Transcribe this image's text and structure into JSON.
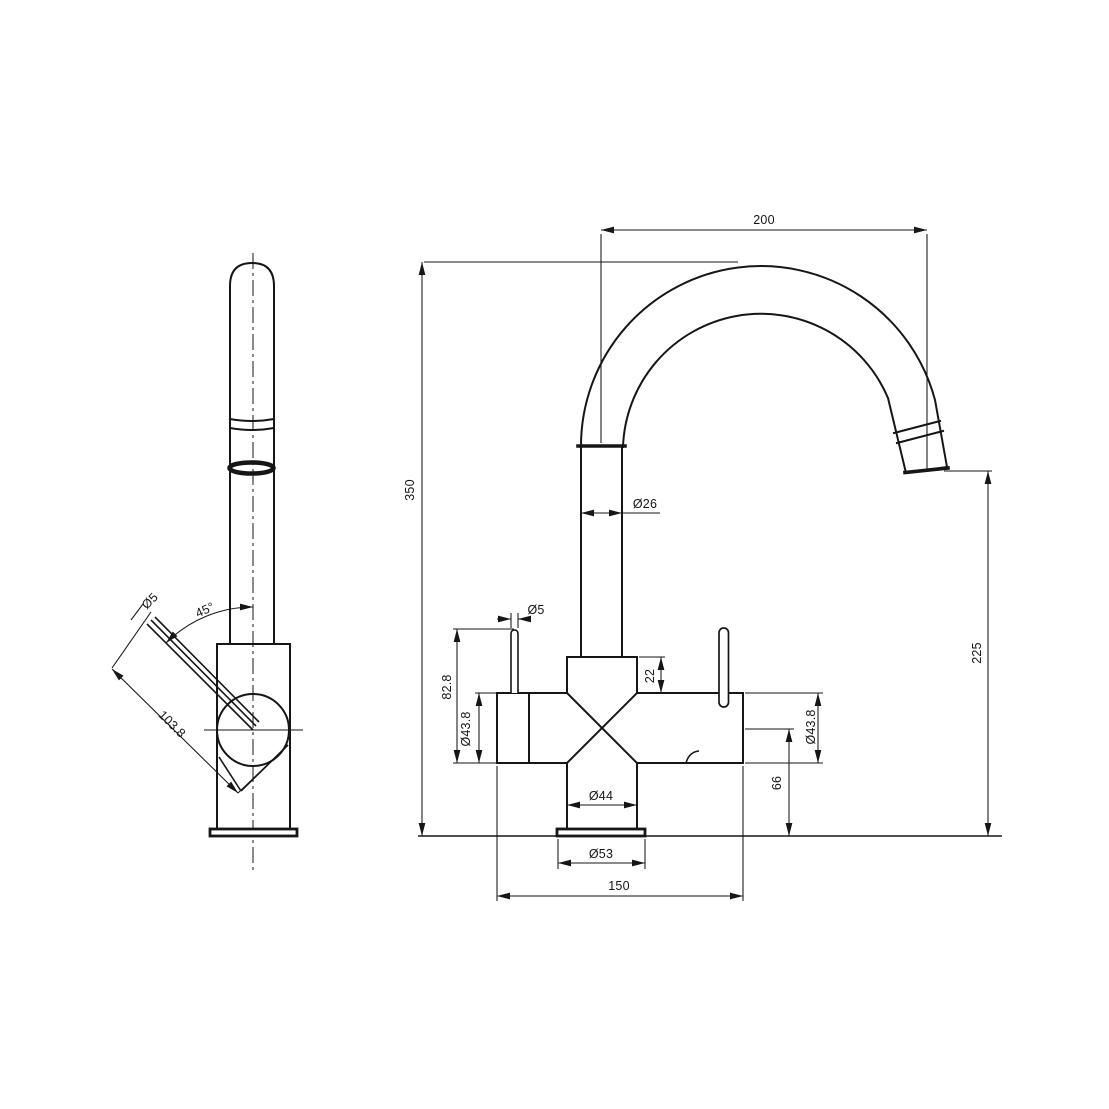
{
  "colors": {
    "background": "#ffffff",
    "line": "#161616"
  },
  "labels": {
    "reach": "200",
    "overall_height": "350",
    "spout_diameter": "Ø26",
    "pin_diameter_front": "Ø5",
    "handle_height": "82.8",
    "handle_diameter_left": "Ø43.8",
    "top_section_height": "22",
    "neck_diameter": "Ø44",
    "base_diameter": "Ø53",
    "footprint_width": "150",
    "outlet_center_height": "66",
    "handle_diameter_right": "Ø43.8",
    "spout_outlet_height": "225",
    "pin_diameter_side": "Ø5",
    "lever_angle": "45°",
    "lever_length": "103.8"
  }
}
